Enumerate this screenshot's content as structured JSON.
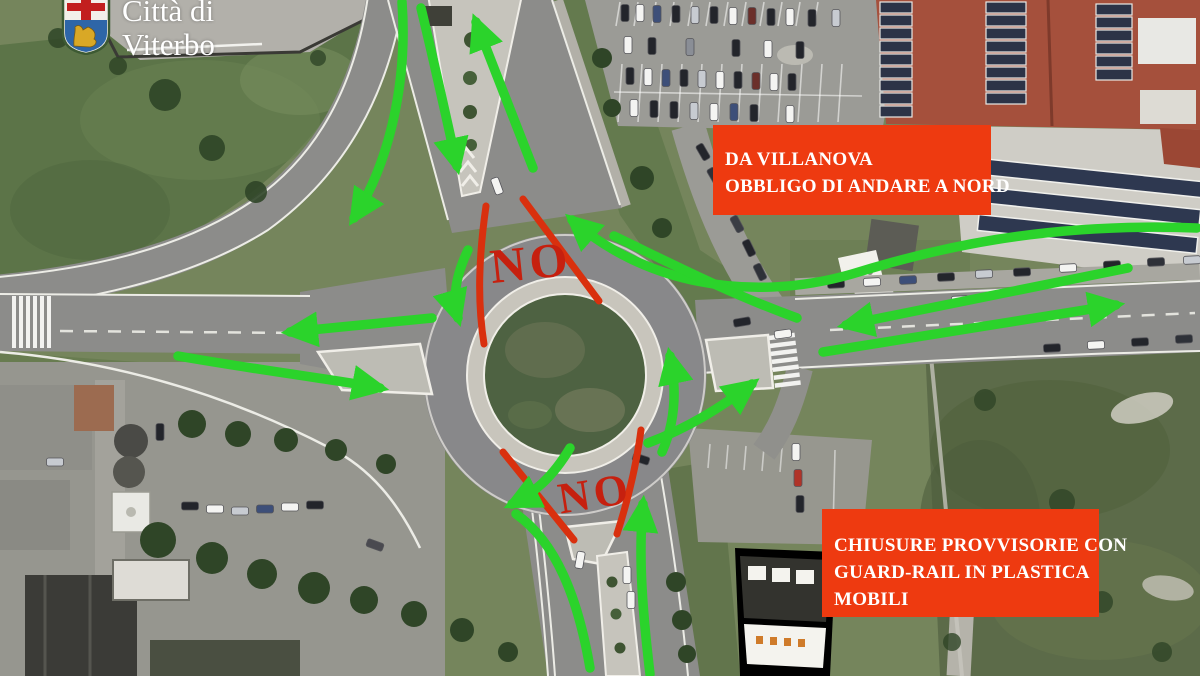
{
  "logo": {
    "line1": "Città di",
    "line2": "Viterbo"
  },
  "annotations": {
    "no_top": "NO",
    "no_bottom": "NO"
  },
  "callouts": {
    "villanova": {
      "lines": [
        "DA VILLANOVA",
        "OBBLIGO DI ANDARE A NORD"
      ]
    },
    "chiusure": {
      "lines": [
        "CHIUSURE PROVVISORIE CON",
        "GUARD-RAIL IN PLASTICA",
        "MOBILI"
      ]
    }
  },
  "colors": {
    "arrow_green": "#2bd32b",
    "marking_red": "#d9300e",
    "callout_bg": "#ee3a10",
    "callout_text": "#ffffff",
    "no_red": "#c6200f"
  }
}
